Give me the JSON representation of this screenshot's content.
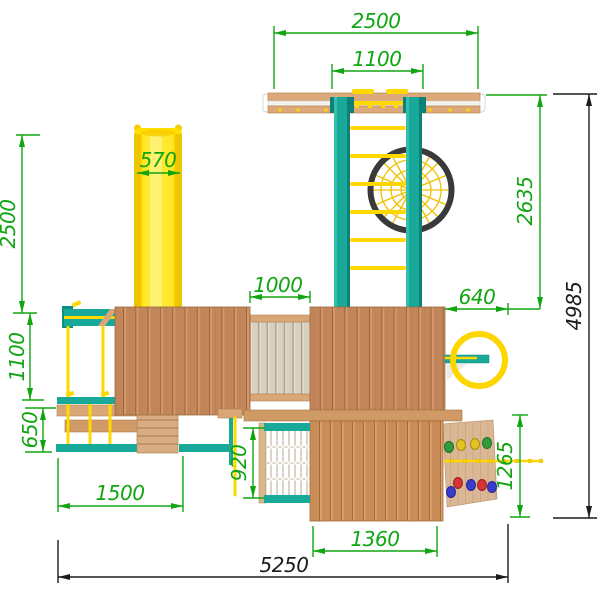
{
  "drawing": {
    "type": "playground-equipment-elevation",
    "dims": {
      "top_width": "2500",
      "top_inner_width": "1100",
      "slide_width": "570",
      "left_height": "2500",
      "left_upper_height": "1100",
      "left_lower_height": "650",
      "frame_height": "2635",
      "total_height": "4985",
      "bridge_length": "1000",
      "frame_offset": "640",
      "net_height": "920",
      "swing_span": "1500",
      "lower_platform_width": "1360",
      "wall_height": "1265",
      "total_width": "5250"
    },
    "colors": {
      "dimension_green": "#11a511",
      "dimension_black": "#1c1c1c",
      "wood": "#c2865a",
      "wood_light": "#d9a678",
      "teal": "#18a99b",
      "yellow": "#ffd800",
      "slide_yellow": "#ffdf00",
      "web_ring": "#3a3a3a",
      "background": "#ffffff"
    }
  }
}
